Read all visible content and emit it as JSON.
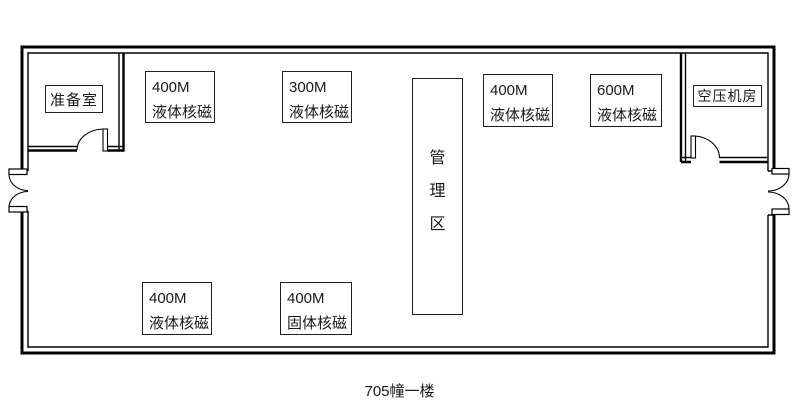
{
  "caption": "705幢一楼",
  "rooms": {
    "prep": {
      "label": "准备室"
    },
    "compressor": {
      "label": "空压机房"
    },
    "admin": {
      "char1": "管",
      "char2": "理",
      "char3": "区"
    }
  },
  "equipment": [
    {
      "power": "400M",
      "type": "液体核磁"
    },
    {
      "power": "300M",
      "type": "液体核磁"
    },
    {
      "power": "400M",
      "type": "液体核磁"
    },
    {
      "power": "600M",
      "type": "液体核磁"
    },
    {
      "power": "400M",
      "type": "液体核磁"
    },
    {
      "power": "400M",
      "type": "固体核磁"
    }
  ],
  "colors": {
    "wall": "#000000",
    "background": "#ffffff",
    "text": "#1a1a1a"
  }
}
